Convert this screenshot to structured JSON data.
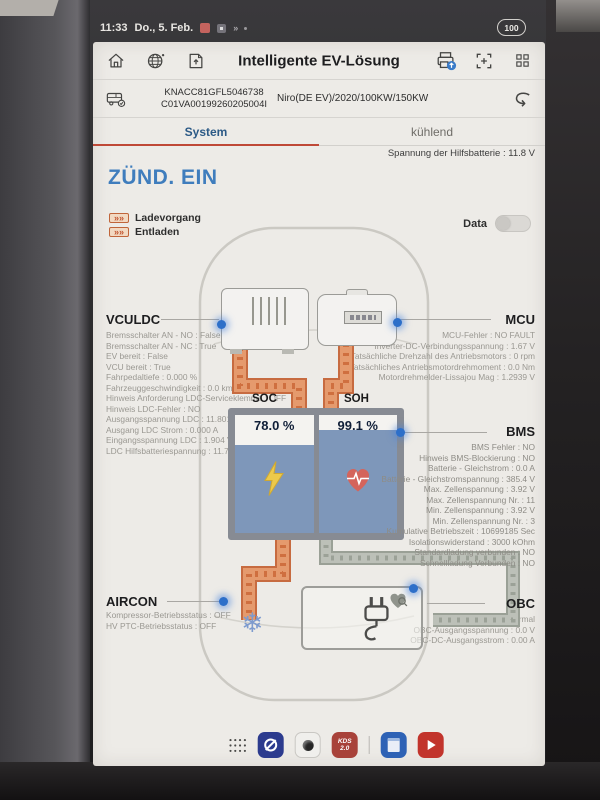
{
  "colors": {
    "screen_bg": "#edebe7",
    "accent_blue": "#3f7dbd",
    "tab_active": "#2c5a86",
    "tab_underline": "#bf4937",
    "pipe_orange": "#e0885b",
    "pipe_gray": "#b7bab2",
    "battery_blue": "#7e97ba",
    "glow_dot": "#2d6fc9",
    "bolt_yellow": "#ecc94b",
    "heart_red": "#d4645c",
    "kds_red": "#a8423a"
  },
  "status_bar": {
    "time": "11:33",
    "date": "Do., 5. Feb.",
    "battery": "100"
  },
  "header": {
    "title": "Intelligente EV-Lösung"
  },
  "vehicle_bar": {
    "vin": "KNACC81GFL5046738",
    "id": "C01VA00199260205004I",
    "model": "Niro(DE EV)/2020/100KW/150KW"
  },
  "tabs": {
    "system": "System",
    "cooling": "kühlend"
  },
  "aux_battery": "Spannung der Hilfsbatterie : 11.8 V",
  "ignition": "ZÜND. EIN",
  "legend": {
    "charging": "Ladevorgang",
    "discharging": "Entladen",
    "data_label": "Data",
    "data_on": false
  },
  "battery_gauge": {
    "soc_label": "SOC",
    "soc_value": "78.0 %",
    "soc_percent": 78,
    "soh_label": "SOH",
    "soh_value": "99.1 %",
    "soh_percent": 99.1
  },
  "sections": {
    "vculdc": {
      "title": "VCULDC",
      "lines": [
        "Bremsschalter AN - NO : False",
        "Bremsschalter AN - NC : True",
        "EV bereit : False",
        "VCU bereit : True",
        "Fahrpedaltiefe : 0.000 %",
        "Fahrzeuggeschwindigkeit : 0.0 km/h",
        "Hinweis Anforderung LDC-Serviceklemme : OFF",
        "Hinweis LDC-Fehler : NO",
        "Ausgangsspannung LDC : 11.801 V",
        "Ausgang LDC Strom : 0.000 A",
        "Eingangsspannung LDC : 1.904 V",
        "LDC Hilfsbatteriespannung : 11.7171 V"
      ]
    },
    "mcu": {
      "title": "MCU",
      "lines": [
        "MCU-Fehler : NO FAULT",
        "Inverter-DC-Verbindungsspannung : 1.67 V",
        "Tatsächliche Drehzahl des Antriebsmotors : 0 rpm",
        "Tatsächliches Antriebsmotordrehmoment : 0.0 Nm",
        "Motordrehmelder-Lissajou Mag : 1.2939 V"
      ]
    },
    "bms": {
      "title": "BMS",
      "lines": [
        "BMS Fehler : NO",
        "Hinweis BMS-Blockierung : NO",
        "Batterie - Gleichstrom : 0.0 A",
        "Batterie - Gleichstromspannung : 385.4 V",
        "Max. Zellenspannung : 3.92 V",
        "Max. Zellenspannung Nr. : 11",
        "Min. Zellenspannung : 3.92 V",
        "Min. Zellenspannung Nr. : 3",
        "Kumulative Betriebszeit : 10699185 Sec",
        "Isolationswiderstand : 3000 kOhm",
        "Standardladung verbunden : NO",
        "Schnellladung Verbunden : NO"
      ]
    },
    "aircon": {
      "title": "AIRCON",
      "lines": [
        "Kompressor-Betriebsstatus : OFF",
        "HV PTC-Betriebsstatus : OFF"
      ]
    },
    "obc": {
      "title": "OBC",
      "lines": [
        "OBC-Fehlerstatus : Normal",
        "OBC-Ausgangsspannung : 0.0 V",
        "OBC-DC-Ausgangsstrom : 0.00 A"
      ]
    }
  },
  "dock": {
    "kds_line1": "KDS",
    "kds_line2": "2.0"
  }
}
